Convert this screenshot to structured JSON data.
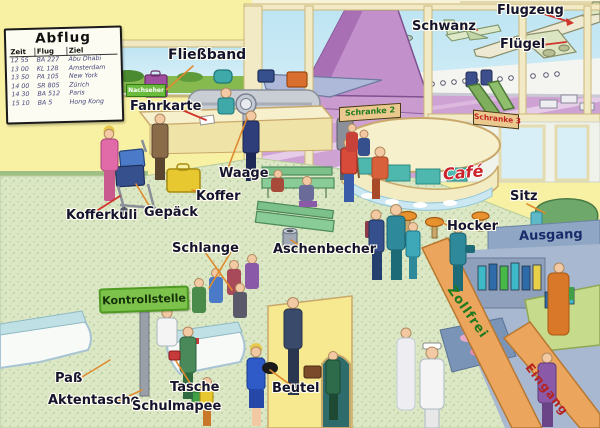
{
  "board": {
    "title": "Abflug",
    "columns": [
      "Zeit",
      "Flug",
      "Ziel"
    ],
    "rows": [
      [
        "12 55",
        "BA 227",
        "Abu Dhabi"
      ],
      [
        "13 00",
        "KL 128",
        "Amsterdam"
      ],
      [
        "13 50",
        "PA 105",
        "New York"
      ],
      [
        "14 00",
        "SR 805",
        "Zürich"
      ],
      [
        "14 30",
        "BA 512",
        "Paris"
      ],
      [
        "15 10",
        "BA 5",
        "Hong Kong"
      ]
    ]
  },
  "labels": {
    "fliessband": "Fließband",
    "fahrkarte": "Fahrkarte",
    "waage": "Waage",
    "koffer": "Koffer",
    "gepaeck": "Gepäck",
    "kofferkuli": "Kofferkuli",
    "schlange": "Schlange",
    "pass": "Paß",
    "aktentasche": "Aktentasche",
    "tasche": "Tasche",
    "schulmapee": "Schulmapee",
    "beutel": "Beutel",
    "aschenbecher": "Aschenbecher",
    "schwanz": "Schwanz",
    "flugzeug": "Flugzeug",
    "fluegel": "Flügel",
    "sitz": "Sitz",
    "hocker": "Hocker"
  },
  "signs": {
    "nachseher": "Nachseher",
    "kontrollstelle": "Kontrollstelle",
    "schranke2": "Schranke 2",
    "schranke3": "Schranke 3",
    "cafe": "Café",
    "ausgang": "Ausgang",
    "zollfrei": "Zollfrei",
    "eingang": "Eingang"
  },
  "colors": {
    "wall": "#F8F1A3",
    "floor": "#DCE8C5",
    "sky": "#C6E9F4",
    "tarmac": "#CEA3D4",
    "grass": "#84B94E",
    "label_text": "#14142E",
    "sign_green": "#7DC24B",
    "cafe_red": "#CC2229",
    "beam_orange": "#EBA55C",
    "ausgang_band": "#8FA7C4"
  }
}
